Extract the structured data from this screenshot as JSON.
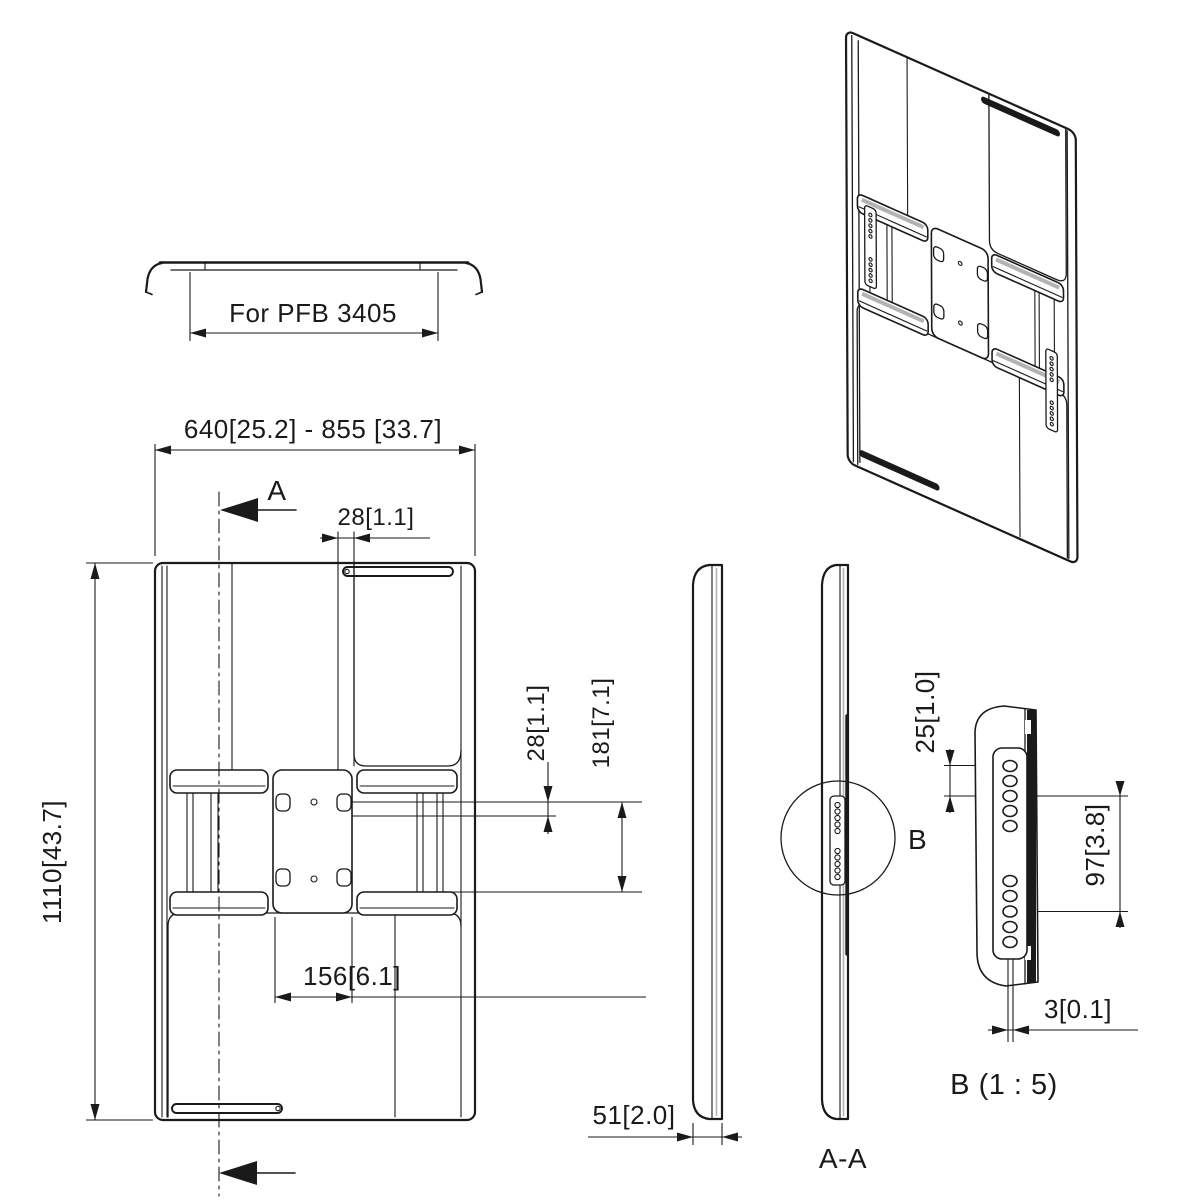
{
  "drawing_type": "technical-dimension-drawing",
  "dims": {
    "profile_width": "For PFB 3405",
    "front_width_range": "640[25.2] - 855 [33.7]",
    "front_height": "1110[43.7]",
    "top_hook_gap": "28[1.1]",
    "hole_row_offset": "28[1.1]",
    "hole_row_span": "181[7.1]",
    "hole_spacing_h": "156[6.1]",
    "side_depth": "51[2.0]",
    "detail_hole_pitch": "25[1.0]",
    "detail_group_span": "97[3.8]",
    "detail_plate_thickness": "3[0.1]"
  },
  "labels": {
    "section_arrow": "A",
    "section_view": "A-A",
    "detail_marker": "B",
    "detail_view_title": "B (1 : 5)"
  },
  "colors": {
    "line": "#1a1a1a",
    "background": "#ffffff",
    "shade": "#b3b3b3"
  }
}
